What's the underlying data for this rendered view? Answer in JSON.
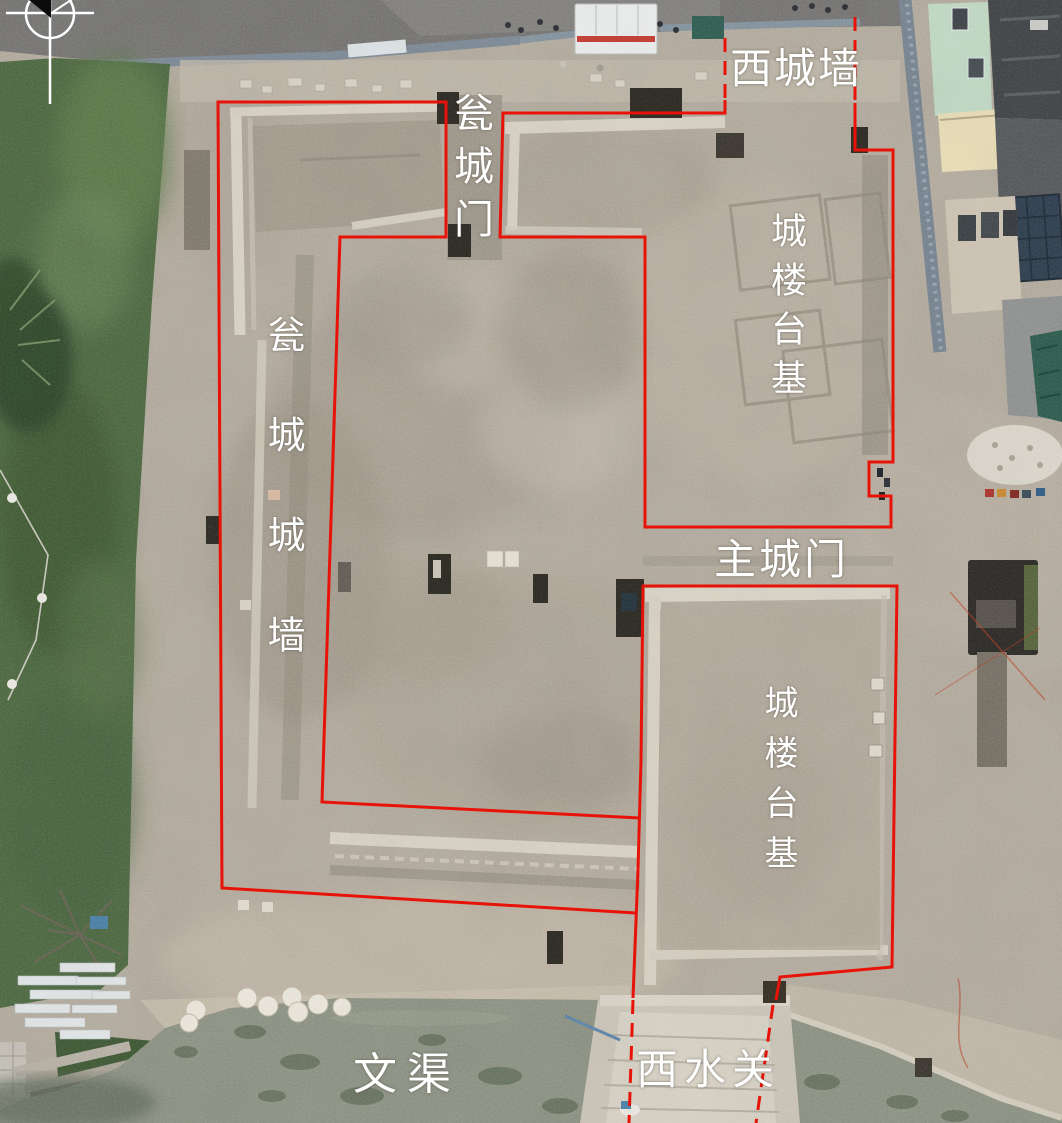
{
  "figure": {
    "labels": {
      "west_city_wall": "西城墙",
      "barbican_gate": "瓮城门",
      "gate_tower_platform_upper": "城楼台基",
      "barbican_city_wall": "瓮城城墙",
      "main_city_gate": "主城门",
      "gate_tower_platform_lower": "城楼台基",
      "wen_canal": "文渠",
      "west_water_gate": "西水关"
    },
    "icons": {
      "north_indicator": "compass-north-arrow"
    },
    "colors": {
      "annotation_red": "#e81308",
      "label_white": "#ffffff",
      "earth_tan": "#b1a99c",
      "grass_green": "#4c6741",
      "water_green": "#8b9182",
      "limestone_wall": "#d8d2c4"
    }
  }
}
